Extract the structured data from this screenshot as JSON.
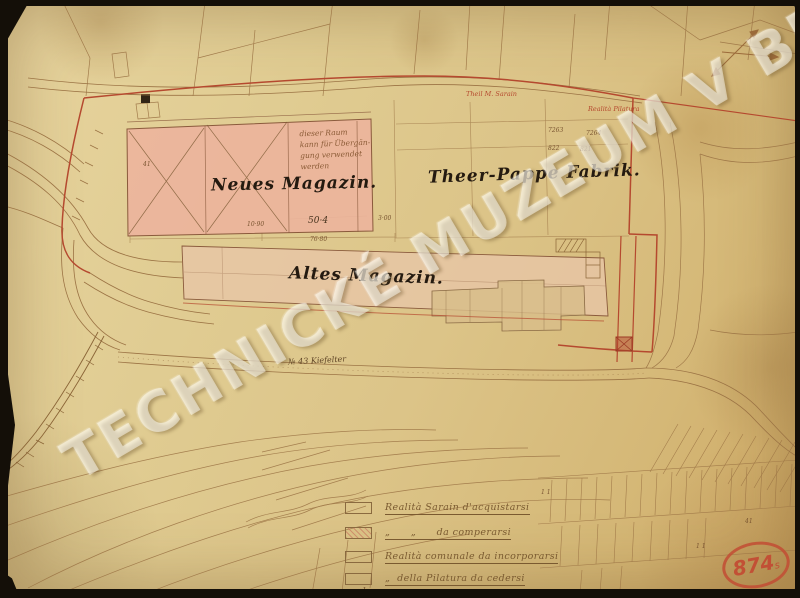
{
  "watermark": {
    "text": "TECHNICKÉ MUZEUM V BRNĚ"
  },
  "map": {
    "building_labels": {
      "neues_magazin": "Neues Magazin.",
      "theer_pappe_fabrik": "Theer-Pappe Fabrik.",
      "altes_magazin": "Altes Magazin."
    },
    "handwritten_note": {
      "line1": "dieser Raum",
      "line2": "kann für Übergän-",
      "line3": "gung verwendet",
      "line4": "werden"
    },
    "red_annotations": {
      "sarain": "Theil M. Sarain",
      "pilatura": "Realità Pilatura"
    },
    "road_label": "№ 43 Kiefelter",
    "dimensions": {
      "width_neues": "50·4",
      "left_segment": "10·90",
      "total_bottom": "76·80",
      "gap": "3·00",
      "left_mark": "41"
    },
    "parcel_numbers": {
      "p7263": "7263",
      "p7264": "7264",
      "p822": "822",
      "p821": "821",
      "field_a": "1 1",
      "field_b": "41",
      "field_c": "1 1"
    }
  },
  "legend": {
    "items": [
      {
        "label": "Realità Sarain d'acquistarsi"
      },
      {
        "label": "„      „      da comperarsi"
      },
      {
        "label": "Realità comunale da incorporarsi"
      },
      {
        "label": "„  della Pilatura da cedersi",
        "label2": "al comune"
      }
    ]
  },
  "stamp": {
    "number": "874",
    "suffix": "s"
  },
  "colors": {
    "paper": "#ddc489",
    "boundary_red": "#b5492f",
    "building_pink": "#ecb49c",
    "line_sepia": "#9b7344",
    "stamp_red": "#c44c34",
    "watermark_white": "#fffdf4"
  }
}
